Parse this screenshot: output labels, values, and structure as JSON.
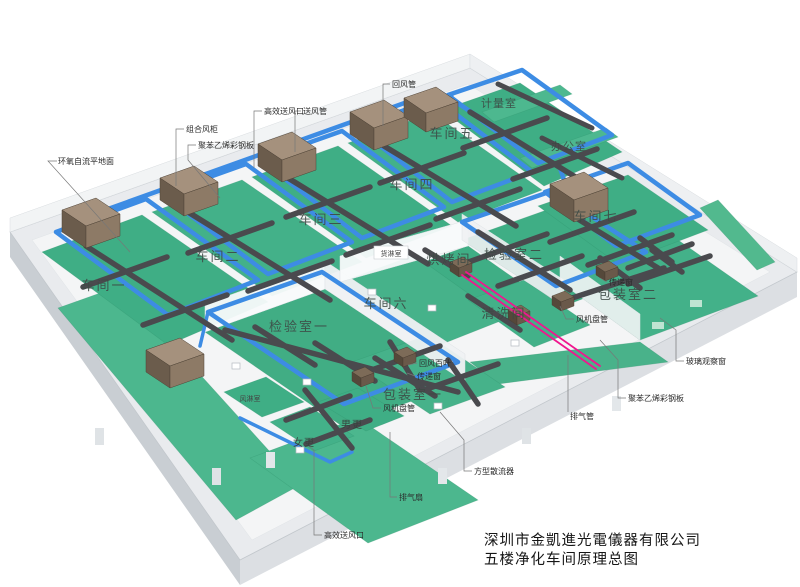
{
  "title_block": {
    "company": "深圳市金凱進光電儀器有限公司",
    "drawing": "五楼净化车间原理总图"
  },
  "rooms": [
    {
      "id": "workshop-1",
      "label": "车间一"
    },
    {
      "id": "workshop-2",
      "label": "车间二"
    },
    {
      "id": "workshop-3",
      "label": "车间三"
    },
    {
      "id": "workshop-4",
      "label": "车间四"
    },
    {
      "id": "workshop-5",
      "label": "车间五"
    },
    {
      "id": "workshop-6",
      "label": "车间六"
    },
    {
      "id": "workshop-7",
      "label": "车间七"
    },
    {
      "id": "inspection-room-1",
      "label": "检验室一"
    },
    {
      "id": "inspection-room-2",
      "label": "检验室二"
    },
    {
      "id": "packing-room-1",
      "label": "包装室一"
    },
    {
      "id": "packing-room-2",
      "label": "包装室二"
    },
    {
      "id": "cleaning-room",
      "label": "清洗间"
    },
    {
      "id": "baking-room",
      "label": "烘烤间"
    },
    {
      "id": "office",
      "label": "办公室"
    },
    {
      "id": "metrology-room",
      "label": "计量室"
    },
    {
      "id": "cargo-shower-room",
      "label": "货淋室"
    },
    {
      "id": "air-shower-room",
      "label": "风淋室"
    },
    {
      "id": "men-changing-room",
      "label": "男更"
    },
    {
      "id": "women-changing-room",
      "label": "女更"
    }
  ],
  "callouts": [
    {
      "id": "epoxy-self-leveling-floor",
      "label": "环氧自流平地面"
    },
    {
      "id": "combined-air-cabinet",
      "label": "组合风柜"
    },
    {
      "id": "polystyrene-panel-left",
      "label": "聚苯乙烯彩钢板"
    },
    {
      "id": "hepa-supply-outlet-top",
      "label": "高效送风口"
    },
    {
      "id": "supply-air-duct",
      "label": "送风管"
    },
    {
      "id": "return-air-duct",
      "label": "回风管"
    },
    {
      "id": "return-air-louver",
      "label": "回风百叶"
    },
    {
      "id": "pass-window-mid",
      "label": "传递窗"
    },
    {
      "id": "pass-window-right",
      "label": "传递窗"
    },
    {
      "id": "fan-coil-right",
      "label": "风机盘管"
    },
    {
      "id": "fan-coil-mid",
      "label": "风机盘管"
    },
    {
      "id": "exhaust-pipe",
      "label": "排气管"
    },
    {
      "id": "polystyrene-panel-right",
      "label": "聚苯乙烯彩钢板"
    },
    {
      "id": "glass-observation-window",
      "label": "玻璃观察窗"
    },
    {
      "id": "square-diffuser",
      "label": "方型散流器"
    },
    {
      "id": "exhaust-fan",
      "label": "排气扇"
    },
    {
      "id": "hepa-supply-outlet-bottom",
      "label": "高效送风口"
    }
  ],
  "colors": {
    "floor_green": "#3fae85",
    "duct_blue": "#3d8ce4",
    "duct_gray": "#4a4a4e",
    "ahu_brown": "#8d7a66",
    "exhaust_pink": "#f0168f"
  }
}
